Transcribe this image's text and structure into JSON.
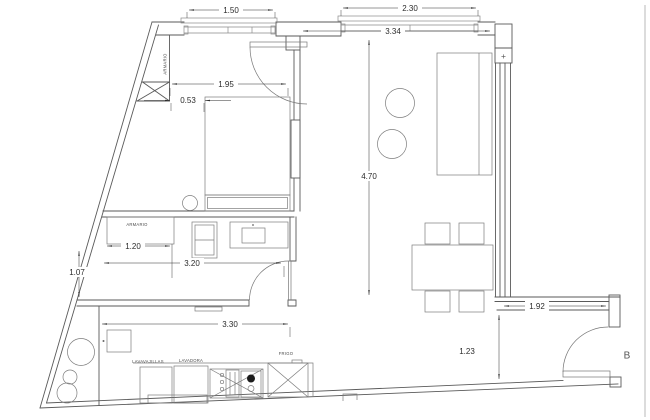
{
  "app": {
    "type": "cad-floor-plan",
    "background": "#ffffff",
    "wall_color": "#5a5a5a",
    "dimension_color": "#2e2e2e"
  },
  "dims": {
    "bedroom_window": "1.50",
    "living_window": "2.30",
    "living_width": "3.34",
    "bedroom_width": "1.95",
    "bed_gap": "0.53",
    "living_length": "4.70",
    "closet_width": "1.20",
    "room_width": "3.20",
    "left_segment": "1.07",
    "kitchen_width": "3.30",
    "balcony_opening": "1.92",
    "entry_passage": "1.23"
  },
  "labels": {
    "armario_top": "ARMARIO",
    "armario_mid": "ARMARIO",
    "lavavajillas": "LAVAVAJILLAS",
    "lavadora": "LAVADORA",
    "frigo": "FRIGO",
    "balcony": "B",
    "plus": "+"
  }
}
